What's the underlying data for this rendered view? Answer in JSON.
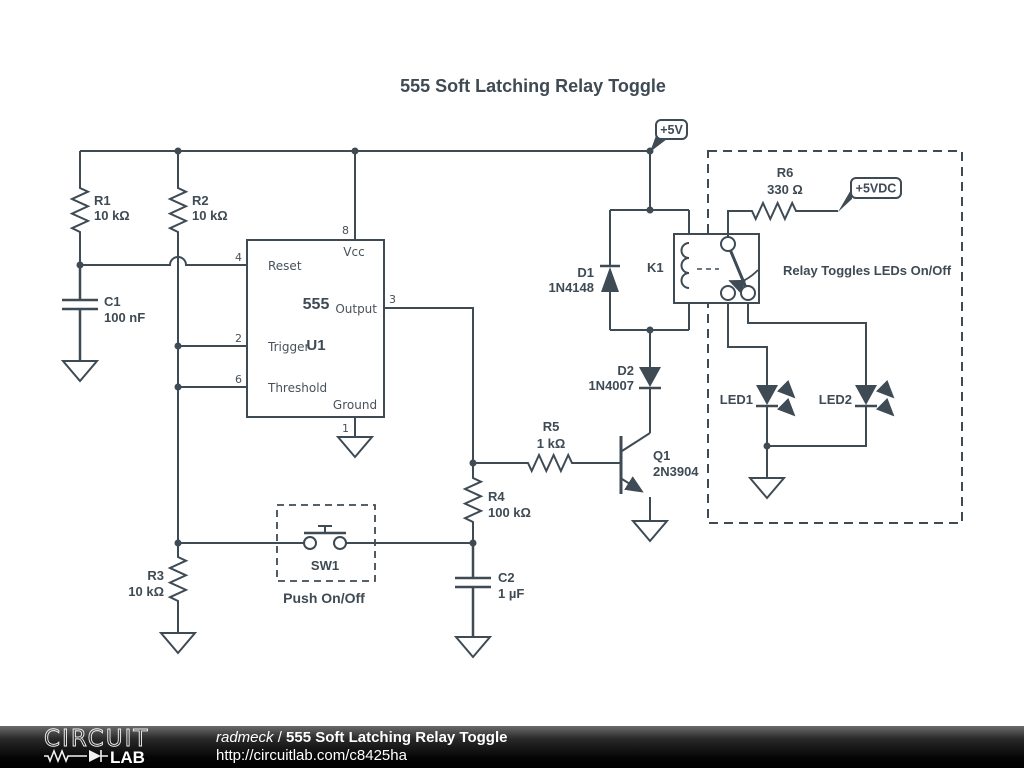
{
  "title": "555 Soft Latching Relay Toggle",
  "flags": {
    "v5": "+5V",
    "v5dc": "+5VDC"
  },
  "ic": {
    "part": "555",
    "ref": "U1",
    "pins": {
      "vcc": {
        "num": "8",
        "label": "Vcc"
      },
      "reset": {
        "num": "4",
        "label": "Reset"
      },
      "trigger": {
        "num": "2",
        "label": "Trigger"
      },
      "threshold": {
        "num": "6",
        "label": "Threshold"
      },
      "output": {
        "num": "3",
        "label": "Output"
      },
      "ground": {
        "num": "1",
        "label": "Ground"
      }
    }
  },
  "components": {
    "r1": {
      "ref": "R1",
      "value": "10 kΩ"
    },
    "r2": {
      "ref": "R2",
      "value": "10 kΩ"
    },
    "r3": {
      "ref": "R3",
      "value": "10 kΩ"
    },
    "r4": {
      "ref": "R4",
      "value": "100 kΩ"
    },
    "r5": {
      "ref": "R5",
      "value": "1 kΩ"
    },
    "r6": {
      "ref": "R6",
      "value": "330 Ω"
    },
    "c1": {
      "ref": "C1",
      "value": "100 nF"
    },
    "c2": {
      "ref": "C2",
      "value": "1 µF"
    },
    "d1": {
      "ref": "D1",
      "value": "1N4148"
    },
    "d2": {
      "ref": "D2",
      "value": "1N4007"
    },
    "q1": {
      "ref": "Q1",
      "value": "2N3904"
    },
    "k1": {
      "ref": "K1"
    },
    "sw1": {
      "ref": "SW1",
      "caption": "Push On/Off"
    },
    "led1": {
      "ref": "LED1"
    },
    "led2": {
      "ref": "LED2"
    }
  },
  "annotations": {
    "relay_note": "Relay Toggles LEDs On/Off"
  },
  "footer": {
    "logo_top": "CIRCUIT",
    "logo_bottom": "LAB",
    "author": "radmeck",
    "separator": " / ",
    "doc_title": "555 Soft Latching Relay Toggle",
    "url": "http://circuitlab.com/c8425ha"
  },
  "colors": {
    "stroke": "#3e4a54",
    "background": "#ffffff",
    "footer_bg": "#000000",
    "footer_text": "#ffffff"
  }
}
